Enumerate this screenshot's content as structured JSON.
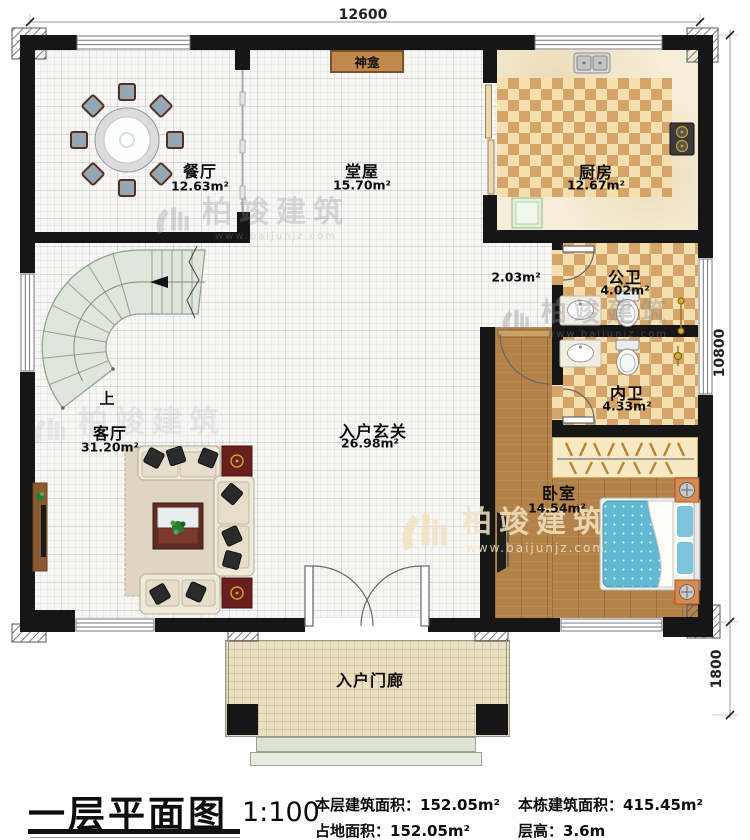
{
  "dimensions": {
    "top": "12600",
    "right_upper": "10800",
    "right_lower": "1800"
  },
  "rooms": {
    "dining": {
      "name": "餐厅",
      "area": "12.63m²"
    },
    "hall": {
      "name": "堂屋",
      "area": "15.70m²"
    },
    "kitchen": {
      "name": "厨房",
      "area": "12.67m²"
    },
    "corridor": {
      "area": "2.03m²"
    },
    "public_bath": {
      "name": "公卫",
      "area": "4.02m²"
    },
    "inner_bath": {
      "name": "内卫",
      "area": "4.33m²"
    },
    "living": {
      "name": "客厅",
      "area": "31.20m²"
    },
    "foyer": {
      "name": "入户玄关",
      "area": "26.98m²"
    },
    "bedroom": {
      "name": "卧室",
      "area": "14.54m²"
    },
    "porch": {
      "name": "入户门廊"
    }
  },
  "annotations": {
    "shrine": "神龛",
    "stairs_up": "上"
  },
  "watermark": {
    "brand": "柏竣建筑",
    "url": "www.baijunjz.com"
  },
  "title_block": {
    "title": "一层平面图",
    "scale": "1:100",
    "stats": [
      {
        "label": "本层建筑面积：",
        "value": "152.05m²"
      },
      {
        "label": "占地面积：",
        "value": "152.05m²"
      },
      {
        "label": "本栋建筑面积：",
        "value": "415.45m²"
      },
      {
        "label": "层高：",
        "value": "3.6m"
      }
    ]
  },
  "colors": {
    "wall": "#161616",
    "checker_dark": "#d5a468",
    "checker_light": "#f6dfae",
    "wood": "#b28249",
    "stair": "#dfe6db",
    "shrine": "#c08a4e",
    "bed": "#62b8d1",
    "end_table": "#6b1f1c"
  }
}
